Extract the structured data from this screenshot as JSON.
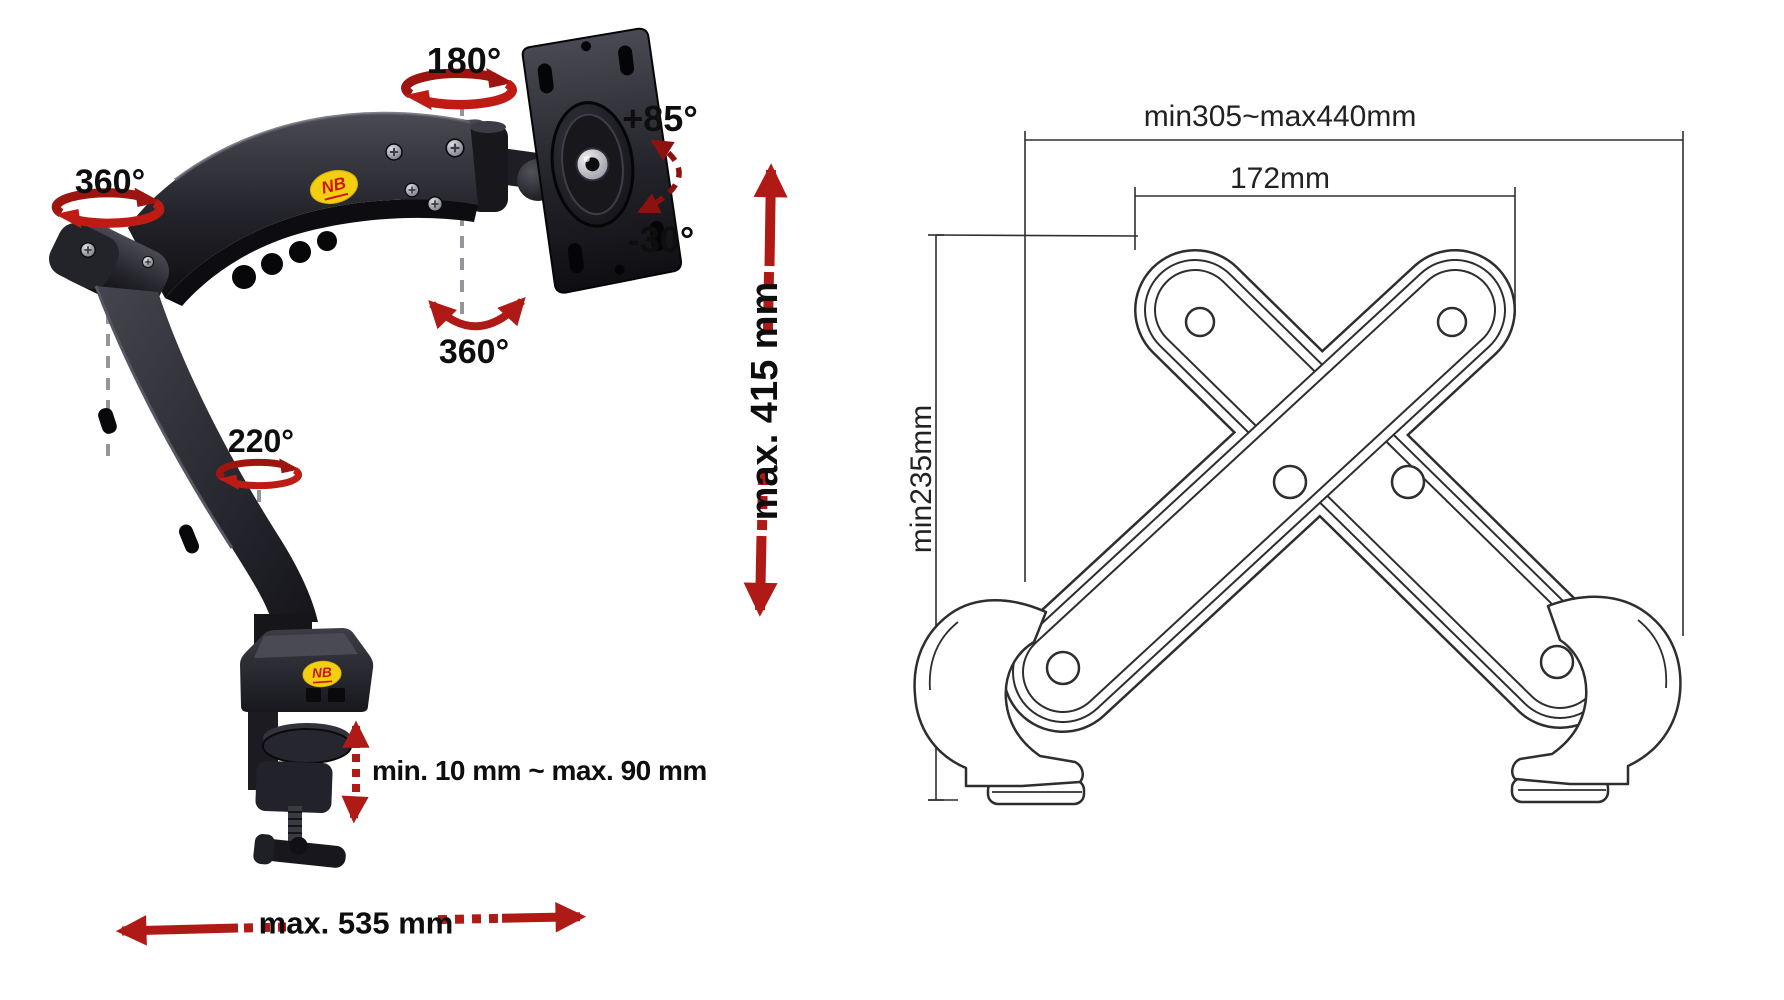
{
  "brand": "NB",
  "colors": {
    "background": "#ffffff",
    "annotation_red": "#b01a16",
    "annotation_dark_red": "#8c1210",
    "dash_gray": "#95959b",
    "drawing_line": "#2e2e2e",
    "arm_black": "#1a1a20",
    "logo_yellow": "#f2cf11",
    "logo_red": "#cf1212",
    "text_black": "#0e0e0e"
  },
  "arm_view": {
    "labels": {
      "swivel_top": "180°",
      "rotate_base": "360°",
      "tilt_up": "+85°",
      "tilt_down": "-30°",
      "rotate_head": "360°",
      "swivel_arm": "220°",
      "height_range": "max. 415 mm",
      "clamp_thickness": "min. 10 mm ~ max. 90 mm",
      "reach": "max. 535 mm"
    }
  },
  "bracket_view": {
    "labels": {
      "width_range": "min305~max440mm",
      "top_width": "172mm",
      "height_min": "min235mm"
    }
  }
}
